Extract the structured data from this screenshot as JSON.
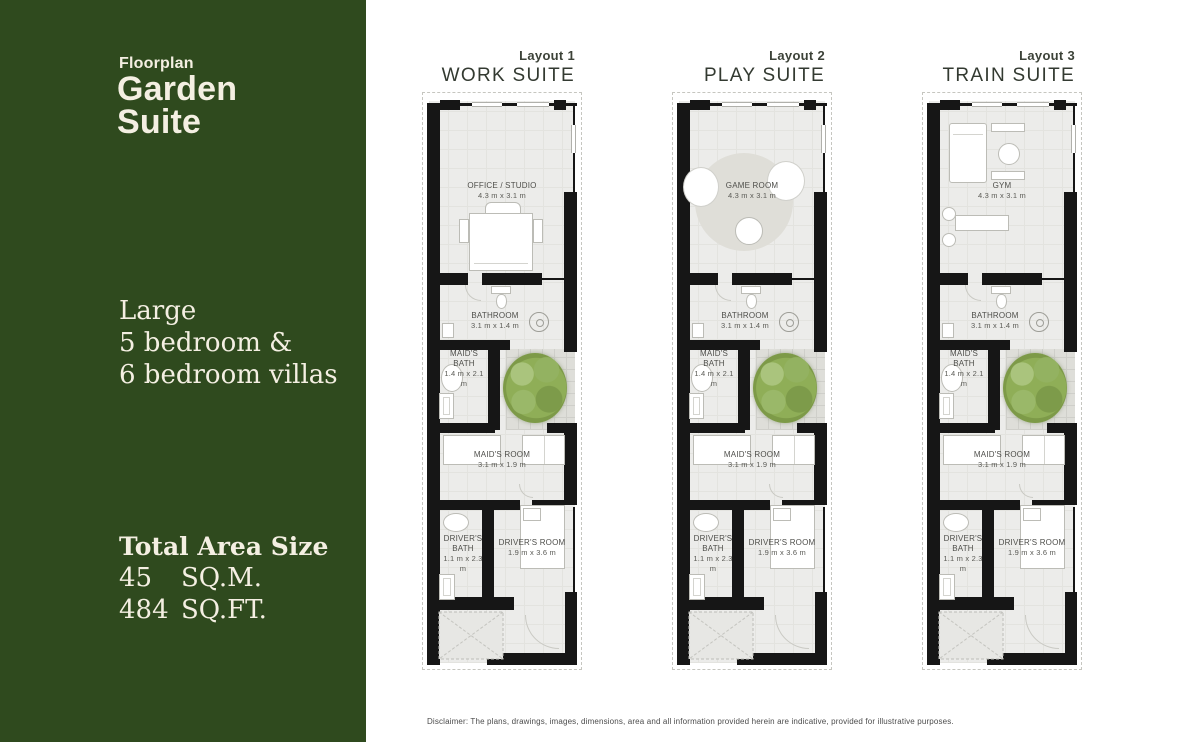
{
  "sidebar": {
    "eyebrow": "Floorplan",
    "title_line1": "Garden",
    "title_line2": "Suite",
    "description_line1": "Large",
    "description_line2": "5 bedroom &",
    "description_line3": "6 bedroom villas",
    "area_heading": "Total Area Size",
    "area_sqm_value": "45",
    "area_sqm_unit": "SQ.M.",
    "area_sqft_value": "484",
    "area_sqft_unit": "SQ.FT."
  },
  "layouts": [
    {
      "layout_label": "Layout 1",
      "suite_name": "WORK SUITE",
      "rooms": {
        "main": {
          "name": "OFFICE / STUDIO",
          "dims": "4.3 m x 3.1 m",
          "variant": "office"
        },
        "bathroom": {
          "name": "BATHROOM",
          "dims": "3.1 m x 1.4 m"
        },
        "maids_bath": {
          "name": "MAID'S BATH",
          "dims": "1.4 m x 2.1 m"
        },
        "maids_room": {
          "name": "MAID'S ROOM",
          "dims": "3.1 m x 1.9 m"
        },
        "drivers_bath": {
          "name": "DRIVER'S BATH",
          "dims": "1.1 m x 2.3 m"
        },
        "drivers_room": {
          "name": "DRIVER'S ROOM",
          "dims": "1.9 m x 3.6 m"
        }
      }
    },
    {
      "layout_label": "Layout 2",
      "suite_name": "PLAY SUITE",
      "rooms": {
        "main": {
          "name": "GAME ROOM",
          "dims": "4.3 m x 3.1 m",
          "variant": "game"
        },
        "bathroom": {
          "name": "BATHROOM",
          "dims": "3.1 m x 1.4 m"
        },
        "maids_bath": {
          "name": "MAID'S BATH",
          "dims": "1.4 m x 2.1 m"
        },
        "maids_room": {
          "name": "MAID'S ROOM",
          "dims": "3.1 m x 1.9 m"
        },
        "drivers_bath": {
          "name": "DRIVER'S BATH",
          "dims": "1.1 m x 2.3 m"
        },
        "drivers_room": {
          "name": "DRIVER'S ROOM",
          "dims": "1.9 m x 3.6 m"
        }
      }
    },
    {
      "layout_label": "Layout 3",
      "suite_name": "TRAIN SUITE",
      "rooms": {
        "main": {
          "name": "GYM",
          "dims": "4.3 m x 3.1 m",
          "variant": "gym"
        },
        "bathroom": {
          "name": "BATHROOM",
          "dims": "3.1 m x 1.4 m"
        },
        "maids_bath": {
          "name": "MAID'S BATH",
          "dims": "1.4 m x 2.1 m"
        },
        "maids_room": {
          "name": "MAID'S ROOM",
          "dims": "3.1 m x 1.9 m"
        },
        "drivers_bath": {
          "name": "DRIVER'S BATH",
          "dims": "1.1 m x 2.3 m"
        },
        "drivers_room": {
          "name": "DRIVER'S ROOM",
          "dims": "1.9 m x 3.6 m"
        }
      }
    }
  ],
  "disclaimer": "Disclaimer: The plans, drawings, images, dimensions, area and all information provided herein are indicative, provided for illustrative purposes.",
  "colors": {
    "sidebar_green": "#2f4a1e",
    "text_cream": "#f4efe2",
    "wall_black": "#161616",
    "floor_gray": "#ececea",
    "tree_green": "#8fae57"
  }
}
